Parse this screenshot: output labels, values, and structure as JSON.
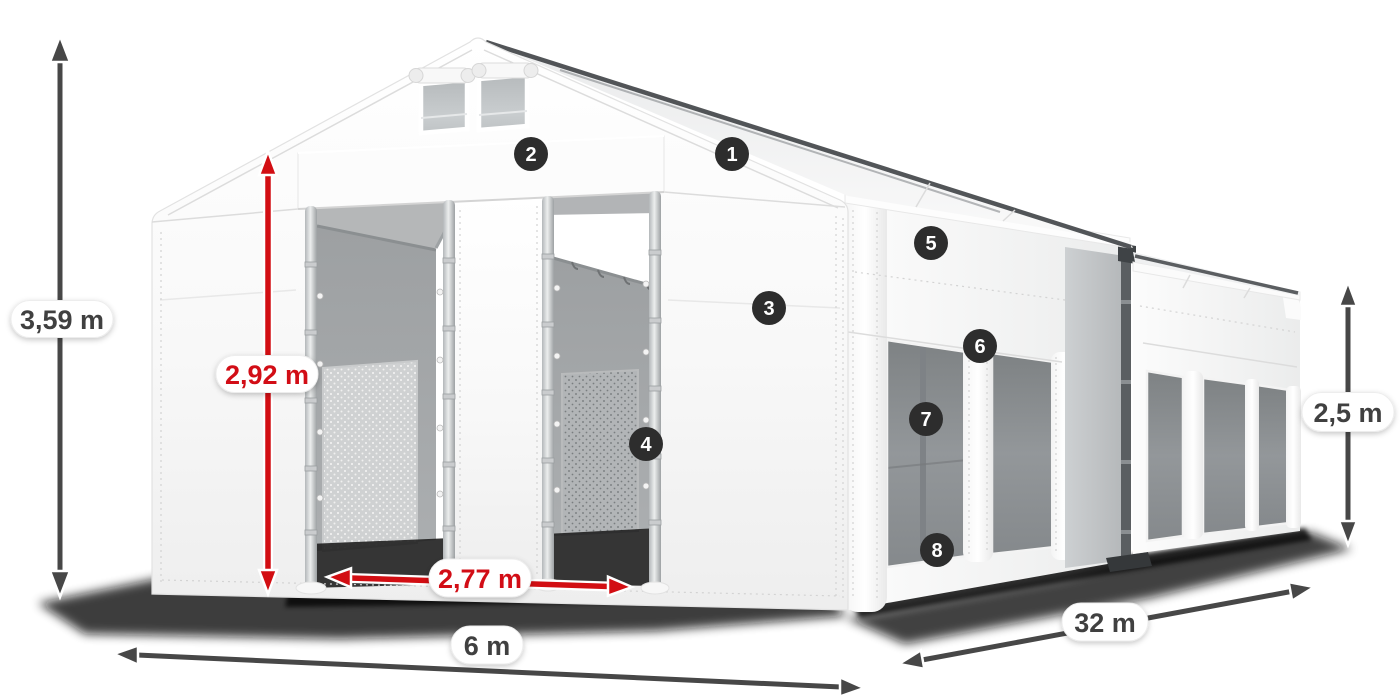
{
  "diagram": {
    "subject": "storage-tent-dimension-diagram",
    "dimensions": {
      "total_height": {
        "label": "3,59 m"
      },
      "entrance_height": {
        "label": "2,92 m"
      },
      "entrance_width": {
        "label": "2,77 m"
      },
      "tent_width": {
        "label": "6 m"
      },
      "tent_length": {
        "label": "32 m"
      },
      "side_height": {
        "label": "2,5 m"
      }
    },
    "feature_markers": [
      {
        "number": "1"
      },
      {
        "number": "2"
      },
      {
        "number": "3"
      },
      {
        "number": "4"
      },
      {
        "number": "5"
      },
      {
        "number": "6"
      },
      {
        "number": "7"
      },
      {
        "number": "8"
      }
    ],
    "colors": {
      "dimension_accent_red": "#d20e13",
      "dimension_neutral_gray": "#474747",
      "marker_background": "#2d2d2d",
      "fabric_white": "#f7f7f7",
      "interior_gray": "#9da0a2"
    }
  }
}
